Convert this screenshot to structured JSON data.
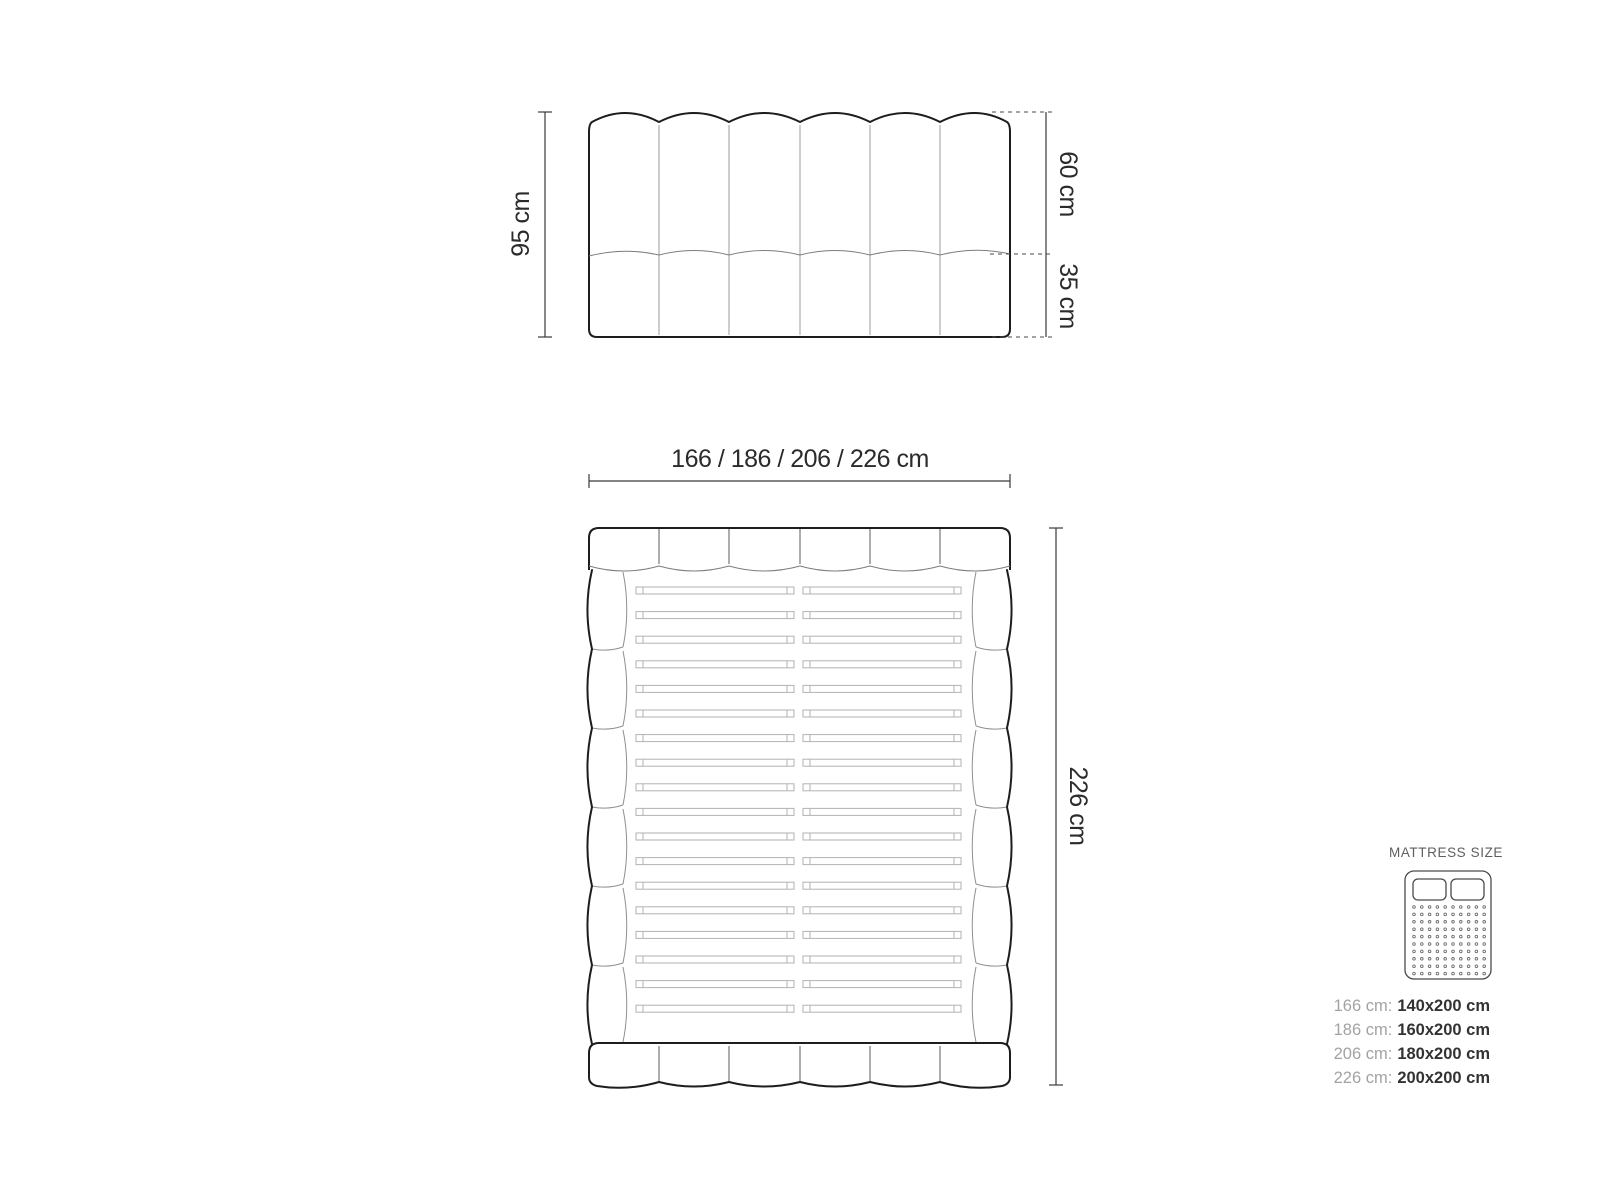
{
  "page": {
    "background": "#ffffff"
  },
  "headboard_front_view": {
    "height_label": "95 cm",
    "upper_section_label": "60 cm",
    "lower_section_label": "35 cm",
    "channel_count": 6
  },
  "bed_top_view": {
    "width_label": "166 / 186 / 206 / 226 cm",
    "length_label": "226 cm",
    "slat_count": 18,
    "side_segment_count": 6,
    "channel_count": 6
  },
  "mattress_legend": {
    "title": "MATTRESS SIZE",
    "rows": [
      {
        "label": "166 cm:",
        "value": "140x200 cm"
      },
      {
        "label": "186 cm:",
        "value": "160x200 cm"
      },
      {
        "label": "206 cm:",
        "value": "180x200 cm"
      },
      {
        "label": "226 cm:",
        "value": "200x200 cm"
      }
    ]
  },
  "colors": {
    "outline": "#1d1d1d",
    "thin_line": "#8f8f8f",
    "slat_line": "#b2b2b2",
    "dimension_line": "#3a3a3a",
    "text": "#2b2b2b",
    "legend_label": "#a3a3a3",
    "legend_value": "#333333",
    "legend_title": "#5f5f5f"
  }
}
